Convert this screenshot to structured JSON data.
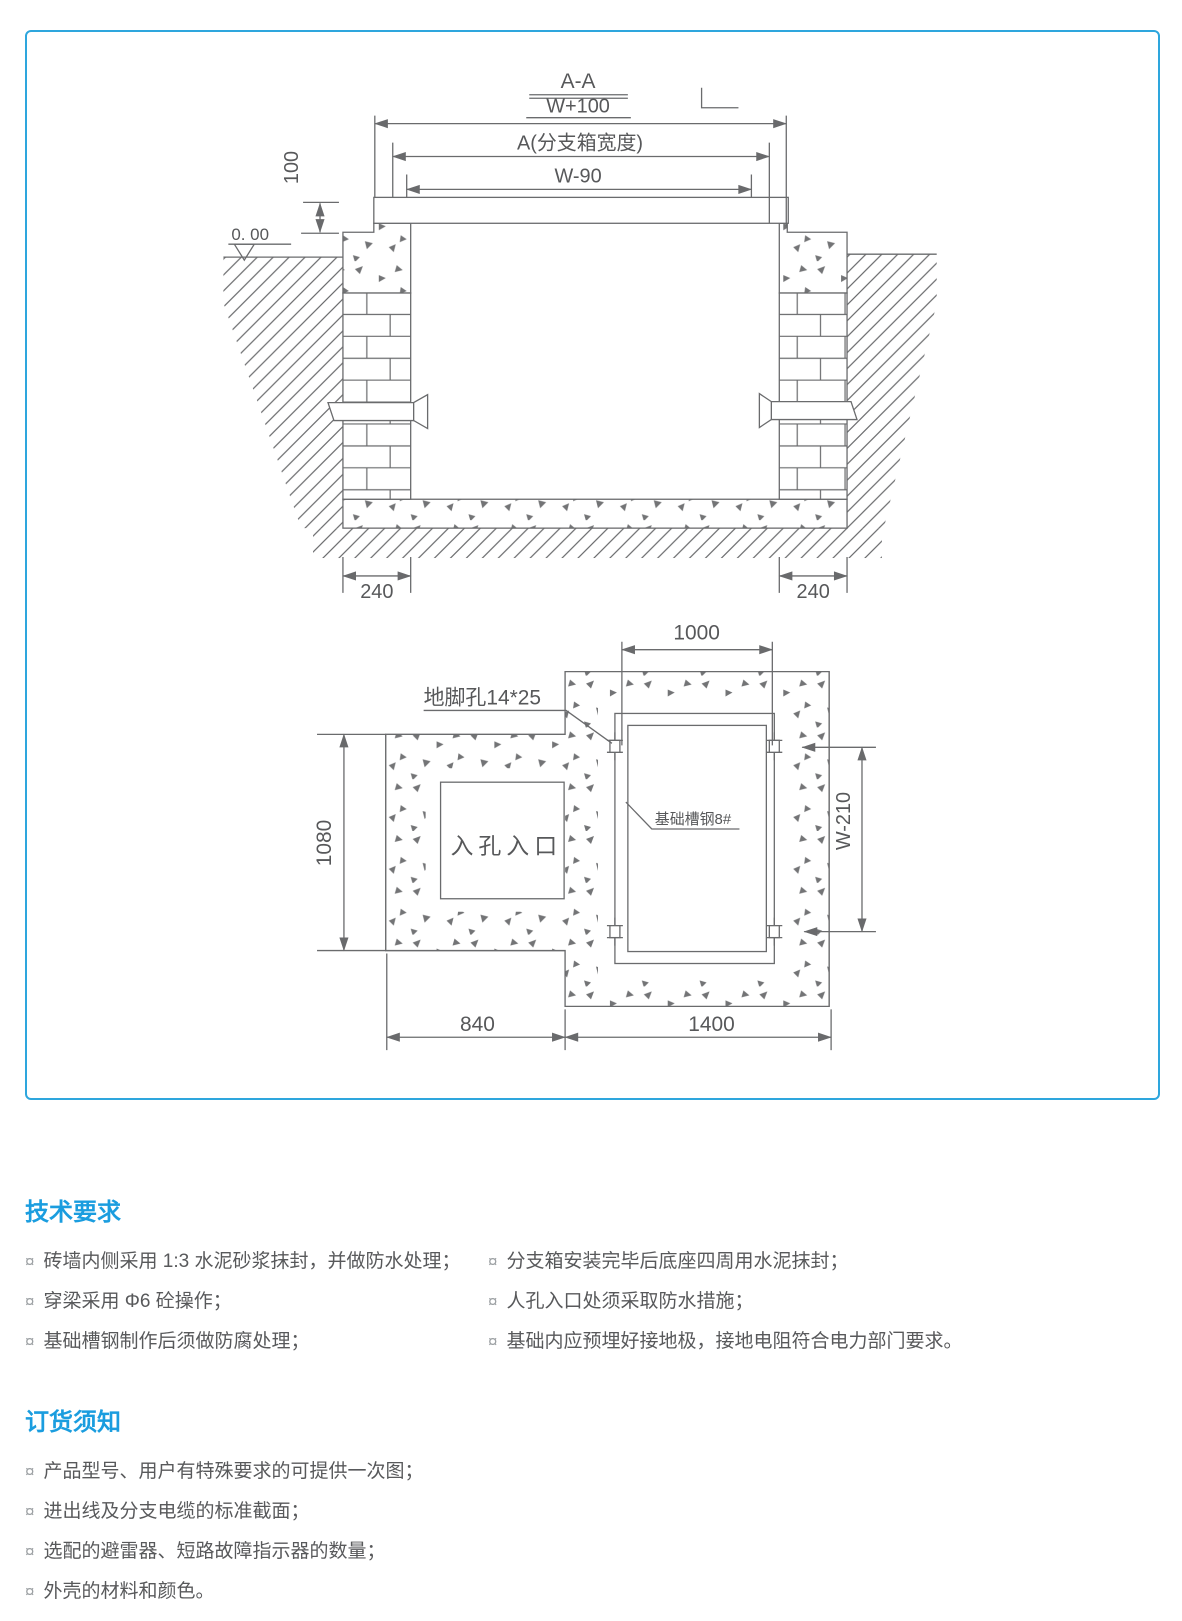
{
  "colors": {
    "accent": "#1a9ddf",
    "text": "#58595b",
    "line": "#6a6b6d",
    "panel_border": "#2ea6dd"
  },
  "bullet_char": "¤",
  "drawing": {
    "section_view": {
      "title": "A-A",
      "overall_width": "W+100",
      "box_width": "A(分支箱宽度)",
      "inner_width": "W-90",
      "slab_offset": "100",
      "ground_level": "0. 00",
      "pier_left": "240",
      "pier_right": "240"
    },
    "plan_view": {
      "top_span": "1000",
      "left_height": "1080",
      "right_span": "W-210",
      "bottom_left": "840",
      "bottom_right": "1400",
      "anchor_hole": "地脚孔14*25",
      "channel_steel": "基础槽钢8#",
      "manhole": "入孔入口"
    }
  },
  "sections": [
    {
      "title": "技术要求",
      "columns": [
        [
          "砖墙内侧采用 1:3 水泥砂浆抹封，并做防水处理；",
          "穿梁采用 Φ6 砼操作；",
          "基础槽钢制作后须做防腐处理；"
        ],
        [
          "分支箱安装完毕后底座四周用水泥抹封；",
          "人孔入口处须采取防水措施；",
          "基础内应预埋好接地极，接地电阻符合电力部门要求。"
        ]
      ]
    },
    {
      "title": "订货须知",
      "items": [
        "产品型号、用户有特殊要求的可提供一次图；",
        "进出线及分支电缆的标准截面；",
        "选配的避雷器、短路故障指示器的数量；",
        "外壳的材料和颜色。"
      ]
    }
  ]
}
